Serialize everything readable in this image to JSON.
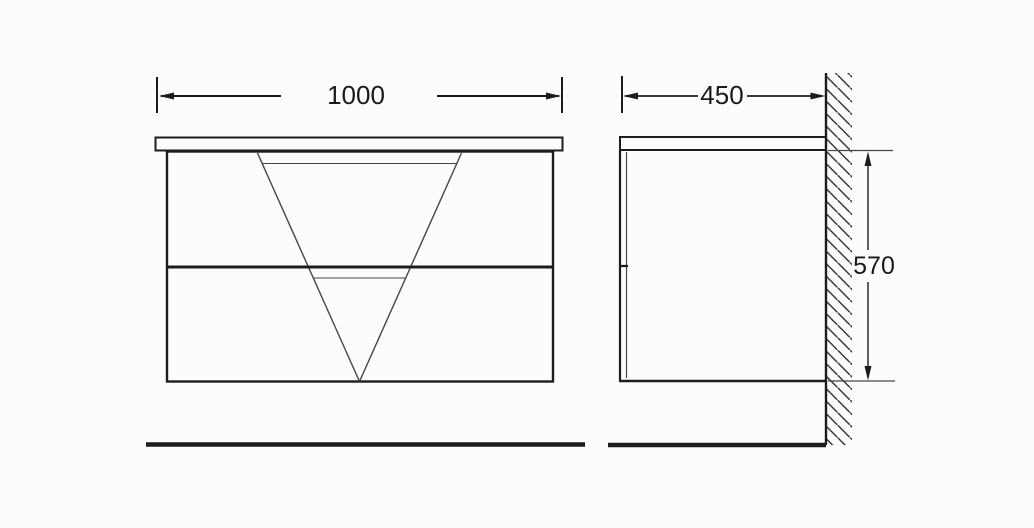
{
  "dimensions": {
    "front_width": "1000",
    "side_depth": "450",
    "side_height": "570"
  },
  "colors": {
    "line": "#1c1c1c",
    "thin_line": "#454545",
    "text": "#1a1a1a",
    "background": "#fcfcfc"
  }
}
